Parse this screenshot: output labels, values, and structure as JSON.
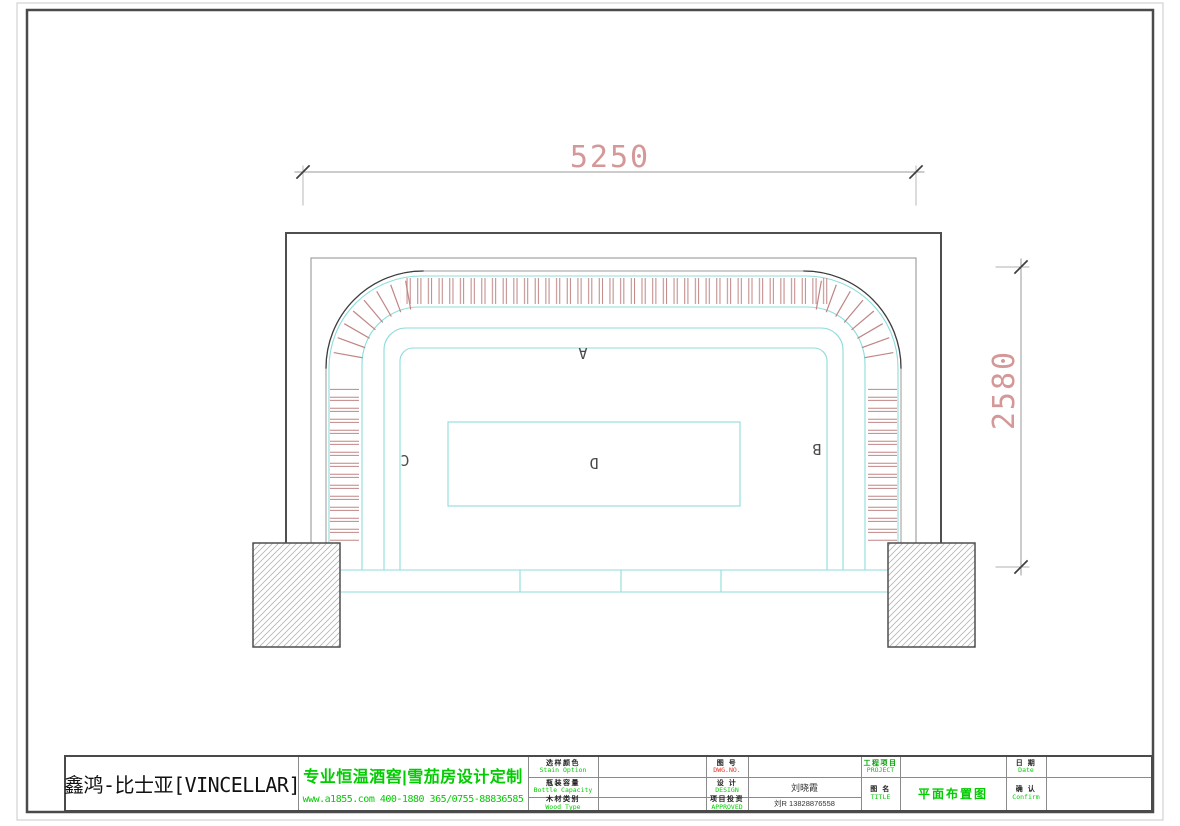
{
  "drawing": {
    "dim_top": "5250",
    "dim_right": "2580",
    "zone_labels": {
      "a": "A",
      "b": "B",
      "c": "C",
      "d": "D"
    }
  },
  "title_block": {
    "company": "鑫鸿-比士亚[VINCELLAR]",
    "slogan": "专业恒温酒窖|雪茄房设计定制",
    "contact": "www.a1855.com 400-1880 365/0755-88836585",
    "fields": {
      "stain": {
        "zh": "选样颜色",
        "en": "Stain Option",
        "value": ""
      },
      "bottle": {
        "zh": "瓶装容量",
        "en": "Bottle Capacity",
        "value": ""
      },
      "wood": {
        "zh": "木材类别",
        "en": "Wood Type",
        "value": ""
      },
      "dwg": {
        "zh": "图 号",
        "en": "DWG.NO.",
        "value": ""
      },
      "design": {
        "zh": "设 计",
        "en": "DESIGN",
        "value": "刘晓霞"
      },
      "approved": {
        "zh": "项目投资",
        "en": "APPROVED",
        "value": "刘R 13828876558"
      },
      "project": {
        "zh": "工程项目",
        "en": "PROJECT",
        "value": ""
      },
      "title": {
        "zh": "图 名",
        "en": "TITLE",
        "value": "平面布置图"
      },
      "date": {
        "zh": "日 期",
        "en": "Date",
        "value": ""
      },
      "confirm": {
        "zh": "确 认",
        "en": "Confirm",
        "value": ""
      }
    }
  },
  "colors": {
    "accent_green": "#00cc00",
    "dwg_no_red": "#e63322",
    "cad_cyan": "#8edcdc",
    "slat_red": "#c08585",
    "dim_salmon": "#d49898"
  }
}
